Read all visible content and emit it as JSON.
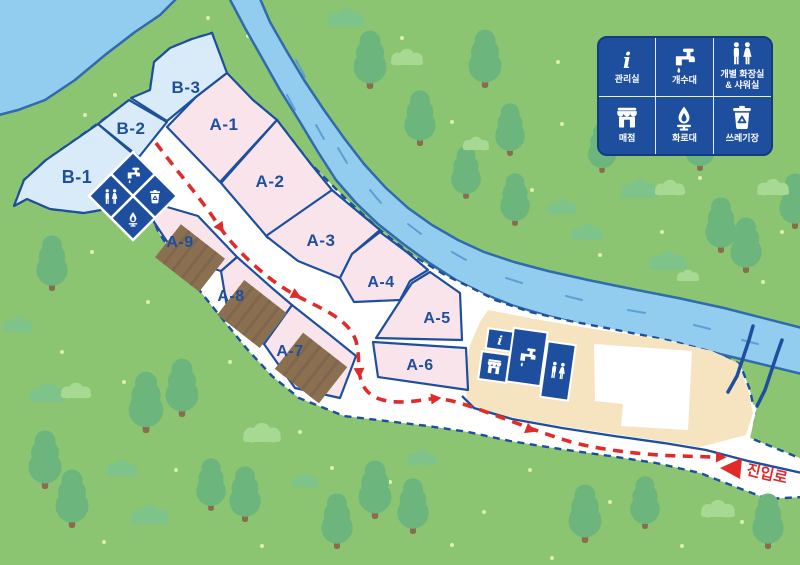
{
  "map": {
    "plots": [
      {
        "id": "B-1",
        "label": "B-1",
        "type": "B"
      },
      {
        "id": "B-2",
        "label": "B-2",
        "type": "B"
      },
      {
        "id": "B-3",
        "label": "B-3",
        "type": "B"
      },
      {
        "id": "A-1",
        "label": "A-1",
        "type": "A"
      },
      {
        "id": "A-2",
        "label": "A-2",
        "type": "A"
      },
      {
        "id": "A-3",
        "label": "A-3",
        "type": "A"
      },
      {
        "id": "A-4",
        "label": "A-4",
        "type": "A"
      },
      {
        "id": "A-5",
        "label": "A-5",
        "type": "A"
      },
      {
        "id": "A-6",
        "label": "A-6",
        "type": "A"
      },
      {
        "id": "A-7",
        "label": "A-7",
        "type": "A",
        "deck": true
      },
      {
        "id": "A-8",
        "label": "A-8",
        "type": "A",
        "deck": true
      },
      {
        "id": "A-9",
        "label": "A-9",
        "type": "A",
        "deck": true
      }
    ],
    "entrance_label": "진입로",
    "facility_cluster_west": [
      "faucet-icon",
      "trash-icon",
      "restroom-icon",
      "fire-icon"
    ],
    "facility_cluster_center": [
      "info-icon",
      "store-icon",
      "faucet-icon",
      "restroom-icon"
    ]
  },
  "legend": {
    "items": [
      {
        "icon": "info-icon",
        "label": "관리실"
      },
      {
        "icon": "faucet-icon",
        "label": "개수대"
      },
      {
        "icon": "restroom-icon",
        "label": "개별 화장실\n& 샤워실"
      },
      {
        "icon": "store-icon",
        "label": "매점"
      },
      {
        "icon": "fire-icon",
        "label": "화로대"
      },
      {
        "icon": "trash-icon",
        "label": "쓰레기장"
      }
    ]
  },
  "colors": {
    "navy": "#1D4F9E",
    "route_red": "#E02B2B",
    "plot_pink": "#FAE4EC",
    "plot_blue": "#D9EBF8",
    "grass": "#8CC571",
    "water": "#92CDEF",
    "water_edge": "#2F6BAD",
    "sand": "#F6E4C0",
    "tree": "#6CB67E",
    "deck_brown": "#8A6F51"
  }
}
